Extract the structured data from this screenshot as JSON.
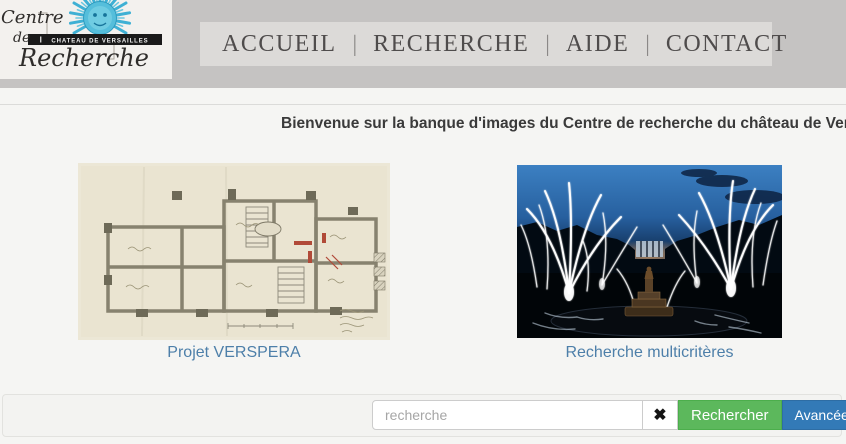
{
  "logo": {
    "line1": "Centre",
    "line2": "de",
    "line3": "Recherche",
    "banner": "CHATEAU DE VERSAILLES"
  },
  "nav": {
    "separator": "|",
    "items": [
      "ACCUEIL",
      "RECHERCHE",
      "AIDE",
      "CONTACT"
    ]
  },
  "main": {
    "heading": "Bienvenue sur la banque d'images du Centre de recherche du château de Versailles"
  },
  "cards": [
    {
      "label": "Projet VERSPERA",
      "image": "architectural-plan-drawing"
    },
    {
      "label": "Recherche multicritères",
      "image": "fireworks-over-versailles-gardens-at-night"
    }
  ],
  "search": {
    "placeholder": "recherche",
    "clear_icon": "✖",
    "submit_label": "Rechercher",
    "advanced_label": "Avancée"
  },
  "colors": {
    "header_band": "#c5c3c2",
    "nav_strip": "#dcdad8",
    "link_blue": "#4d7fa9",
    "button_green": "#5cb85c",
    "button_blue": "#337ab7",
    "logo_cyan": "#45b6d8"
  }
}
